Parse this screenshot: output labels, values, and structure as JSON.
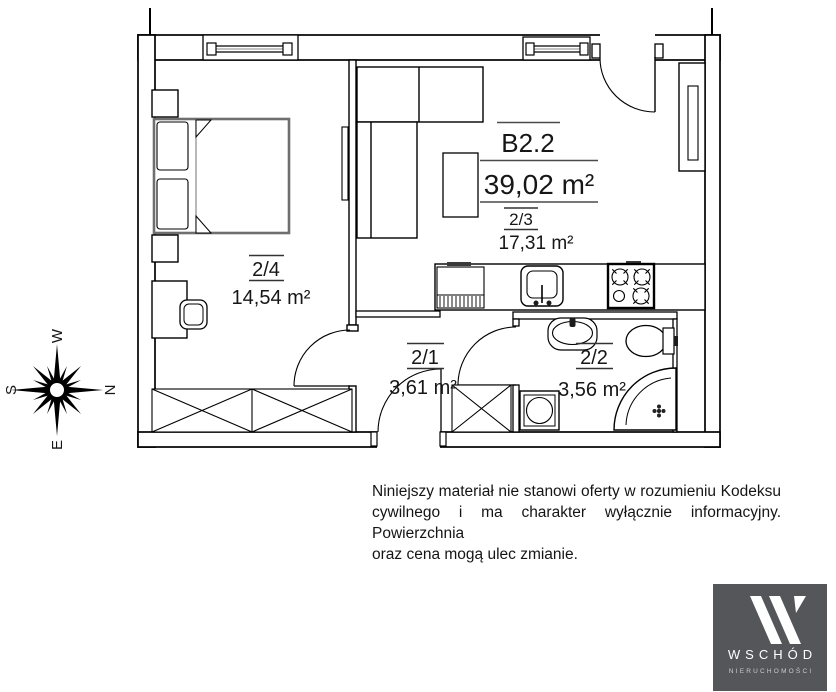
{
  "plan": {
    "unit": {
      "label": "B2.2",
      "area": "39,02 m²"
    },
    "rooms": [
      {
        "number": "2/3",
        "area": "17,31 m²"
      },
      {
        "number": "2/4",
        "area": "14,54 m²"
      },
      {
        "number": "2/1",
        "area": "3,61 m²"
      },
      {
        "number": "2/2",
        "area": "3,56 m²"
      }
    ],
    "compass": {
      "top": "W",
      "right": "N",
      "bottom": "E",
      "left": "S"
    }
  },
  "disclaimer": {
    "lines": [
      "Niniejszy materiał nie stanowi oferty w rozumieniu Kodeksu",
      "cywilnego i ma charakter wyłącznie informacyjny. Powierzchnia",
      "oraz cena mogą ulec zmianie."
    ]
  },
  "logo": {
    "brand": "WSCHÓD",
    "subtitle": "NIERUCHOMOŚCI",
    "bg": "#54565A"
  }
}
